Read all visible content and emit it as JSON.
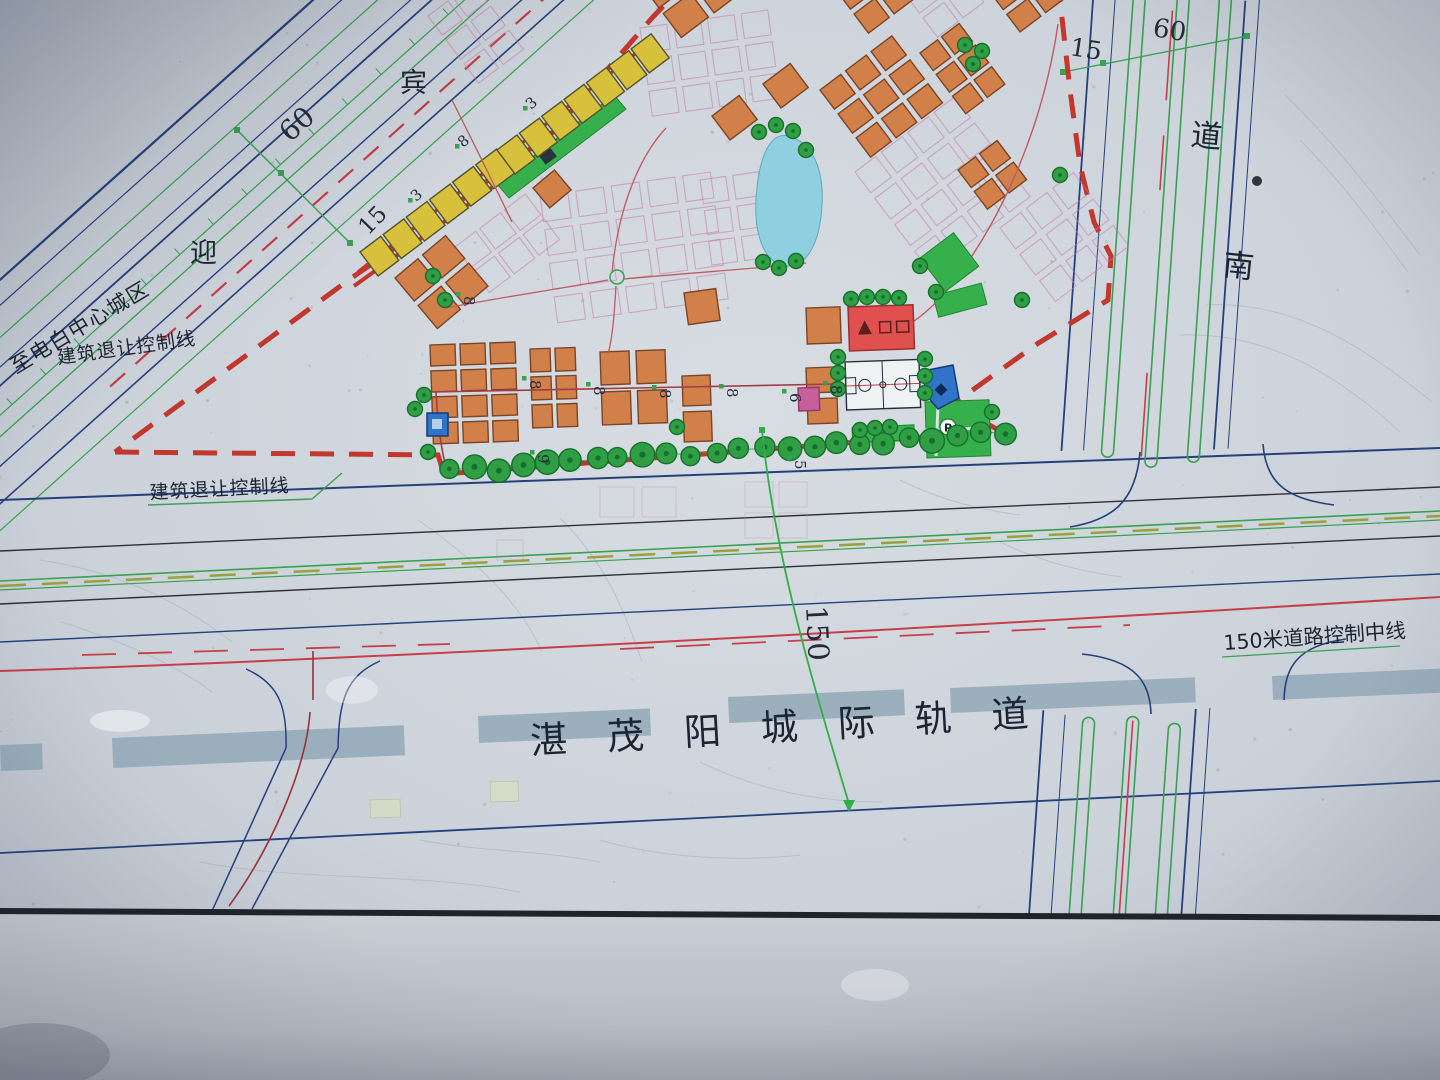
{
  "labels": {
    "destination_left": "至电白中心城区",
    "avenue_char_1": "迎",
    "avenue_char_2": "宾",
    "avenue_width": "60",
    "avenue_green_belt": "15",
    "setback_line_upper": "建筑退让控制线",
    "setback_line_lower": "建筑退让控制线",
    "corridor_width": "150",
    "corridor_centerline": "150米道路控制中线",
    "railway_name": "湛茂阳城际轨道",
    "east_road_char_1": "道",
    "east_road_char_2": "南",
    "east_road_green_belt": "15",
    "east_road_width": "60",
    "parking": "P"
  },
  "colors": {
    "boundary_red": "#c2372e",
    "road_navy": "#26407c",
    "rail_band": "#8fa6b6",
    "pond_blue": "#8fd0e0",
    "school_red": "#e0504f",
    "facility_blue": "#2f74c8",
    "park_green": "#36b04c",
    "plot_pink": "#c279a8"
  },
  "road_width_markers": [
    {
      "v": "8",
      "x": 463,
      "y": 148,
      "r": -40
    },
    {
      "v": "3",
      "x": 416,
      "y": 202,
      "r": -40
    },
    {
      "v": "3",
      "x": 531,
      "y": 110,
      "r": -40
    },
    {
      "v": "8",
      "x": 464,
      "y": 296,
      "r": 90
    },
    {
      "v": "8",
      "x": 530,
      "y": 380,
      "r": 90
    },
    {
      "v": "8",
      "x": 594,
      "y": 386,
      "r": 90
    },
    {
      "v": "8",
      "x": 660,
      "y": 389,
      "r": 90
    },
    {
      "v": "8",
      "x": 727,
      "y": 388,
      "r": 90
    },
    {
      "v": "6",
      "x": 790,
      "y": 393,
      "r": 90
    },
    {
      "v": "8",
      "x": 831,
      "y": 385,
      "r": 90
    },
    {
      "v": "5",
      "x": 795,
      "y": 460,
      "r": 90
    },
    {
      "v": "9",
      "x": 538,
      "y": 454,
      "r": 90
    }
  ],
  "buildings": {
    "palette": {
      "residential": {
        "fill": "#d28049",
        "stroke": "#7a4526"
      },
      "commercial": {
        "fill": "#d7c13c",
        "stroke": "#55522a"
      },
      "mixed": {
        "fill": "#c75f9a",
        "stroke": "#8f3a6e"
      }
    },
    "clusters": [
      {
        "x": 395,
        "y": 278,
        "cols": 2,
        "rows": 2,
        "w": 30,
        "h": 30,
        "gap": 6,
        "rot": -40,
        "type": "residential"
      },
      {
        "x": 430,
        "y": 345,
        "cols": 3,
        "rows": 4,
        "w": 25,
        "h": 21,
        "gap": 5,
        "rot": -2,
        "type": "residential"
      },
      {
        "x": 530,
        "y": 349,
        "cols": 2,
        "rows": 3,
        "w": 20,
        "h": 23,
        "gap": 5,
        "rot": -2,
        "type": "residential"
      },
      {
        "x": 600,
        "y": 352,
        "cols": 2,
        "rows": 2,
        "w": 29,
        "h": 33,
        "gap": 7,
        "rot": -2,
        "type": "residential"
      },
      {
        "x": 682,
        "y": 376,
        "cols": 1,
        "rows": 2,
        "w": 28,
        "h": 30,
        "gap": 6,
        "rot": -2,
        "type": "residential"
      },
      {
        "x": 684,
        "y": 293,
        "cols": 1,
        "rows": 1,
        "w": 32,
        "h": 32,
        "gap": 0,
        "rot": -8,
        "type": "residential"
      },
      {
        "x": 806,
        "y": 308,
        "cols": 1,
        "rows": 1,
        "w": 34,
        "h": 36,
        "gap": 0,
        "rot": -2,
        "type": "residential"
      },
      {
        "x": 806,
        "y": 368,
        "cols": 1,
        "rows": 2,
        "w": 30,
        "h": 25,
        "gap": 6,
        "rot": -2,
        "type": "residential"
      },
      {
        "x": 641,
        "y": -16,
        "cols": 2,
        "rows": 2,
        "w": 34,
        "h": 30,
        "gap": 7,
        "rot": -37,
        "type": "residential"
      },
      {
        "x": 712,
        "y": 116,
        "cols": 1,
        "rows": 1,
        "w": 34,
        "h": 30,
        "gap": 0,
        "rot": -37,
        "type": "residential"
      },
      {
        "x": 763,
        "y": 84,
        "cols": 1,
        "rows": 1,
        "w": 34,
        "h": 30,
        "gap": 0,
        "rot": -37,
        "type": "residential"
      },
      {
        "x": 820,
        "y": 90,
        "cols": 3,
        "rows": 3,
        "w": 26,
        "h": 24,
        "gap": 6,
        "rot": -37,
        "type": "residential"
      },
      {
        "x": 836,
        "y": -10,
        "cols": 2,
        "rows": 2,
        "w": 26,
        "h": 24,
        "gap": 6,
        "rot": -37,
        "type": "residential"
      },
      {
        "x": 920,
        "y": 53,
        "cols": 2,
        "rows": 3,
        "w": 22,
        "h": 22,
        "gap": 5,
        "rot": -37,
        "type": "residential"
      },
      {
        "x": 990,
        "y": -8,
        "cols": 2,
        "rows": 2,
        "w": 26,
        "h": 22,
        "gap": 6,
        "rot": -37,
        "type": "residential"
      },
      {
        "x": 958,
        "y": 170,
        "cols": 2,
        "rows": 2,
        "w": 22,
        "h": 22,
        "gap": 5,
        "rot": -37,
        "type": "residential"
      },
      {
        "x": 533,
        "y": 188,
        "cols": 1,
        "rows": 1,
        "w": 28,
        "h": 26,
        "gap": 0,
        "rot": -40,
        "type": "residential"
      },
      {
        "x": 360,
        "y": 252,
        "cols": 6,
        "rows": 1,
        "w": 26,
        "h": 30,
        "gap": 3,
        "rot": -37,
        "type": "commercial"
      },
      {
        "x": 497,
        "y": 150,
        "cols": 7,
        "rows": 1,
        "w": 25,
        "h": 30,
        "gap": 3,
        "rot": -37,
        "type": "commercial"
      },
      {
        "x": 798,
        "y": 388,
        "cols": 1,
        "rows": 1,
        "w": 21,
        "h": 23,
        "gap": 0,
        "rot": -2,
        "type": "mixed"
      }
    ]
  },
  "plots": {
    "stroke": "#c279a8",
    "clusters": [
      {
        "x": 455,
        "y": 247,
        "cols": 3,
        "rows": 2,
        "w": 26,
        "h": 26,
        "gap": 5,
        "rot": -37
      },
      {
        "x": 540,
        "y": 196,
        "cols": 5,
        "rows": 4,
        "w": 28,
        "h": 26,
        "gap": 8,
        "rot": -8
      },
      {
        "x": 640,
        "y": 28,
        "cols": 4,
        "rows": 3,
        "w": 27,
        "h": 25,
        "gap": 7,
        "rot": -8
      },
      {
        "x": 855,
        "y": 172,
        "cols": 4,
        "rows": 4,
        "w": 26,
        "h": 26,
        "gap": 7,
        "rot": -37
      },
      {
        "x": 1000,
        "y": 228,
        "cols": 3,
        "rows": 3,
        "w": 26,
        "h": 26,
        "gap": 7,
        "rot": -37
      },
      {
        "x": 905,
        "y": -6,
        "cols": 3,
        "rows": 2,
        "w": 26,
        "h": 24,
        "gap": 6,
        "rot": -37
      },
      {
        "x": 428,
        "y": 16,
        "cols": 2,
        "rows": 3,
        "w": 25,
        "h": 24,
        "gap": 6,
        "rot": -37
      },
      {
        "x": 700,
        "y": 180,
        "cols": 2,
        "rows": 3,
        "w": 26,
        "h": 24,
        "gap": 7,
        "rot": -8
      },
      {
        "x": 600,
        "y": 487,
        "cols": 2,
        "rows": 1,
        "w": 34,
        "h": 30,
        "gap": 8,
        "rot": 0,
        "faint": true
      },
      {
        "x": 745,
        "y": 482,
        "cols": 2,
        "rows": 2,
        "w": 28,
        "h": 25,
        "gap": 6,
        "rot": 0,
        "faint": true
      },
      {
        "x": 497,
        "y": 540,
        "cols": 1,
        "rows": 1,
        "w": 26,
        "h": 20,
        "gap": 0,
        "rot": 0,
        "faint": true
      }
    ]
  },
  "trees": {
    "fill": "#2f9e45",
    "stroke": "#15702b",
    "singles": [
      [
        433,
        276
      ],
      [
        445,
        300
      ],
      [
        424,
        395
      ],
      [
        415,
        409
      ],
      [
        428,
        452
      ],
      [
        677,
        427
      ],
      [
        759,
        132
      ],
      [
        776,
        125
      ],
      [
        793,
        131
      ],
      [
        806,
        150
      ],
      [
        763,
        262
      ],
      [
        779,
        268
      ],
      [
        796,
        261
      ],
      [
        851,
        299
      ],
      [
        867,
        297
      ],
      [
        883,
        297
      ],
      [
        899,
        298
      ],
      [
        838,
        357
      ],
      [
        838,
        373
      ],
      [
        838,
        389
      ],
      [
        925,
        359
      ],
      [
        925,
        376
      ],
      [
        925,
        393
      ],
      [
        860,
        430
      ],
      [
        875,
        428
      ],
      [
        890,
        427
      ],
      [
        965,
        45
      ],
      [
        982,
        51
      ],
      [
        973,
        64
      ],
      [
        920,
        266
      ],
      [
        936,
        292
      ],
      [
        992,
        412
      ],
      [
        1060,
        175
      ],
      [
        1022,
        300
      ]
    ],
    "canopy": {
      "x1": 452,
      "y1": 471,
      "x2": 1004,
      "y2": 434,
      "count": 24,
      "r": 11
    }
  }
}
